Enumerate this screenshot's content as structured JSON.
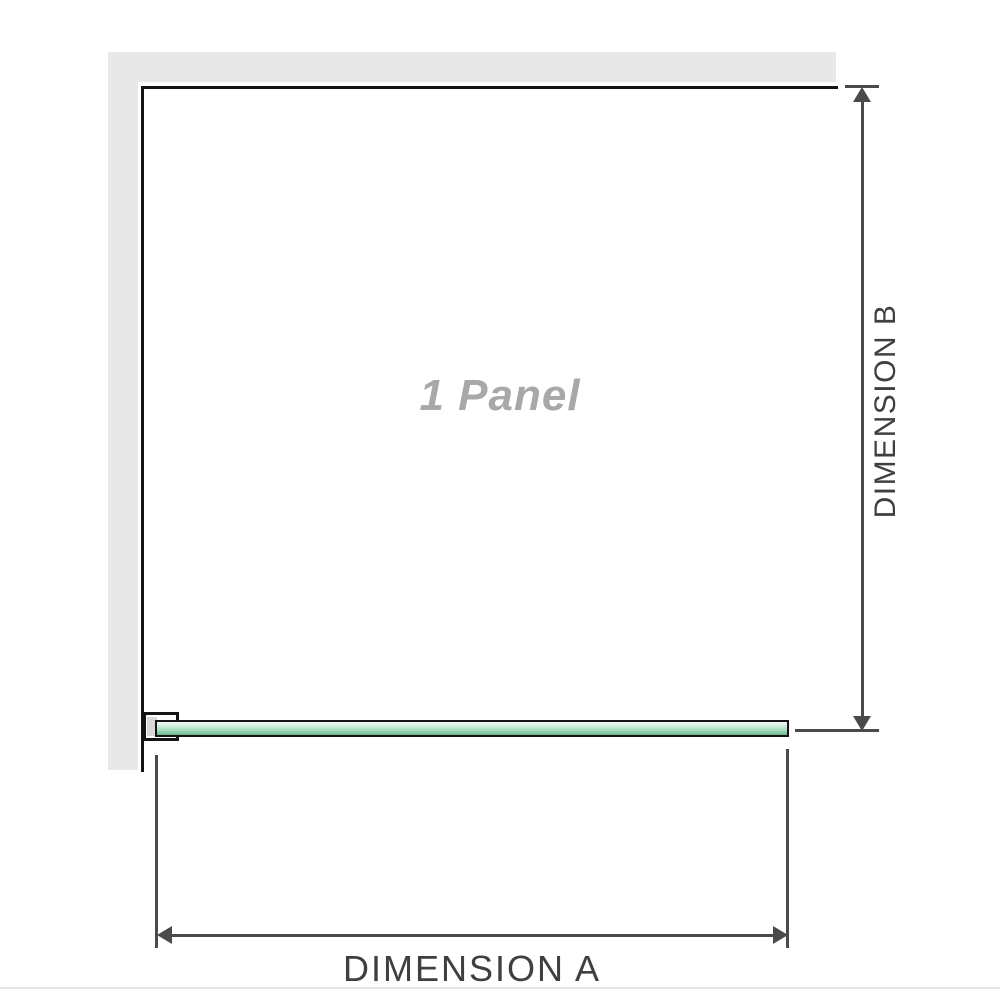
{
  "diagram": {
    "title": "1 Panel",
    "dimension_a": {
      "label": "DIMENSION A"
    },
    "dimension_b": {
      "label": "DIMENSION B"
    },
    "components": {
      "wall": "wall (L-shaped, plan view)",
      "glass_panel": "fixed glass panel (plan view)",
      "wall_clamp": "wall-mount clamp bracket"
    }
  },
  "colors": {
    "wall_fill": "#e8e8e8",
    "outline": "#141414",
    "dimension_line": "#4a4a4a",
    "dimension_text": "#3f3f3f",
    "panel_text": "#a8a8a8",
    "glass_light": "#d5eede",
    "glass_mid": "#a7ddc0",
    "glass_dark": "#84c7a3",
    "clamp_fill": "#d8d8d8",
    "baseline": "#e6e6e1"
  }
}
